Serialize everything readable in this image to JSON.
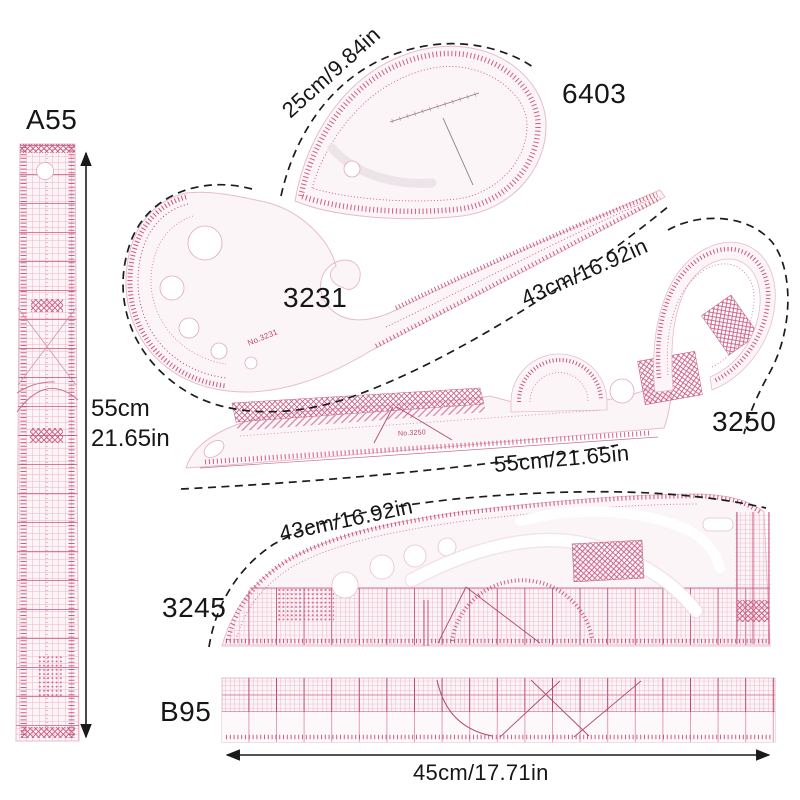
{
  "rulers": {
    "a55": {
      "model": "A55",
      "dimension_line1": "55cm",
      "dimension_line2": "21.65in"
    },
    "teardrop_6403": {
      "model": "6403",
      "dimension": "25cm/9.84in"
    },
    "french_curve_3231": {
      "model": "3231",
      "marking": "No.3231",
      "dimension": "43cm/16.92in"
    },
    "curve_3250": {
      "model": "3250",
      "marking": "No.3250",
      "dimension": "55cm/21.65in"
    },
    "curve_3245": {
      "model": "3245",
      "dimension": "43cm/16.92in"
    },
    "grading_b95": {
      "model": "B95",
      "dimension": "45cm/17.71in"
    }
  },
  "colors": {
    "background": "#ffffff",
    "ruler_body": "#fcf5f8",
    "ruler_edge": "#e6bccb",
    "ruler_ink": "#c23a5e",
    "ruler_ink_light": "#d4789a",
    "ruler_grid": "#eeb3c6",
    "annotation": "#1a1a1a"
  }
}
